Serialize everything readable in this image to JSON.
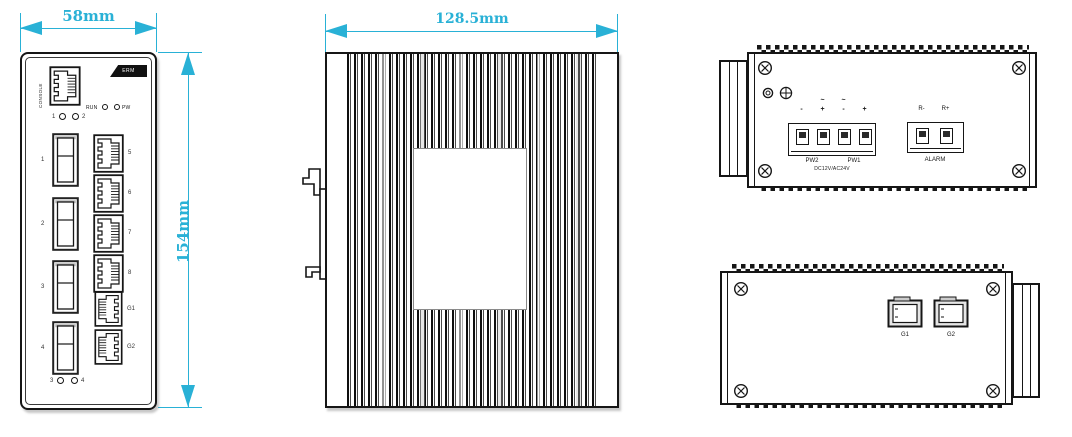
{
  "colors": {
    "dimension_cyan": "#29b1d6",
    "line_black": "#161616"
  },
  "front_view": {
    "width_dim": "58mm",
    "height_dim": "154mm",
    "console_label": "CONSOLE",
    "badge_text": "ERM",
    "run_led_label": "RUN",
    "pw_led_label": "PW",
    "top_leds": [
      "1",
      "2"
    ],
    "bottom_leds": [
      "3",
      "4"
    ],
    "sfp_ports": [
      "1",
      "2",
      "3",
      "4"
    ],
    "rj45_ports": [
      "5",
      "6",
      "7",
      "8"
    ],
    "uplink_ports": [
      "G1",
      "G2"
    ]
  },
  "side_view": {
    "width_dim": "128.5mm"
  },
  "top_view": {
    "power_terminal": {
      "polarity": [
        "-",
        "+",
        "-",
        "+"
      ],
      "ac_marks": [
        "~",
        "~"
      ],
      "pw2_label": "PW2",
      "pw1_label": "PW1",
      "voltage_label": "DC12V/AC24V"
    },
    "alarm_terminal": {
      "pins": [
        "R-",
        "R+"
      ],
      "label": "ALARM"
    }
  },
  "bottom_view": {
    "ports": [
      "G1",
      "G2"
    ]
  }
}
